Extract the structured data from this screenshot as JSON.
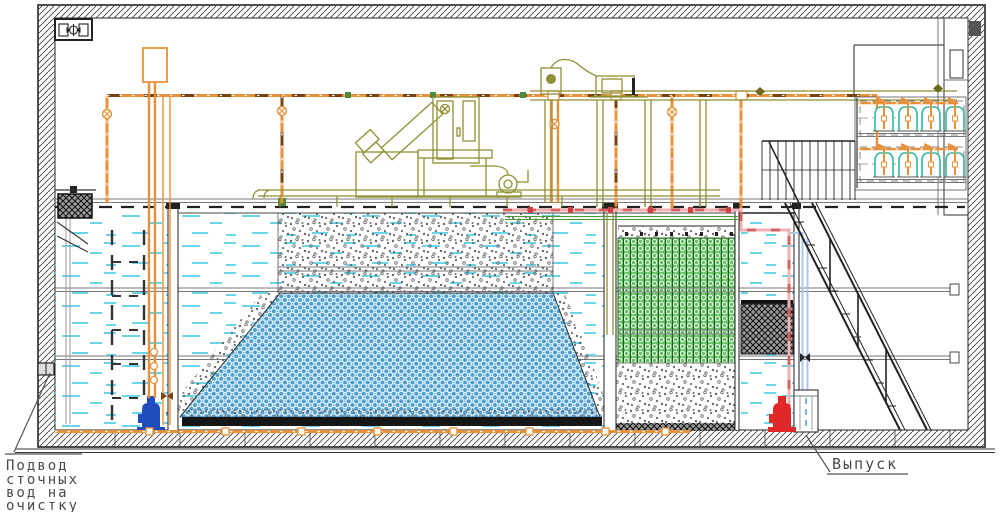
{
  "meta": {
    "title": "Cross-section CAD drawing of a packaged wastewater treatment plant",
    "view": "longitudinal section"
  },
  "labels": {
    "inlet": {
      "lines": [
        "Подвод",
        "сточных",
        "вод на",
        "очистку"
      ]
    },
    "outlet": {
      "text": "Выпуск"
    }
  },
  "colors": {
    "pipe_orange": "#E8913A",
    "pipe_dark_segment": "#7A4210",
    "equipment_olive": "#8F8F33",
    "water_dash_cyan": "#6AD4E8",
    "media_blue": "#4D9FD2",
    "media_green": "#64C064",
    "gravel_gray": "#686868",
    "dark_media": "#9A9A9A",
    "inlet_pump_blue": "#1F4DC0",
    "outlet_pump_red": "#E02828",
    "pipe_pink": "#F2B0B0",
    "pipe_lightblue": "#A9C9E9",
    "diffuser_teal": "#2FB8A3",
    "outline_black": "#222222",
    "label_gray": "#4A4A4A"
  },
  "components": [
    "ventilation-fan",
    "inlet-penetration",
    "basket-screen",
    "receiving-chamber",
    "inlet-pump",
    "feed-tank",
    "screen-press-unit",
    "blower-unit",
    "aeration-tank",
    "gravel-bed",
    "blue-carrier-media",
    "aeration-manifold",
    "biofilter-green-media",
    "dark-filter-media",
    "clear-water-chamber",
    "outlet-pump",
    "outlet-chamber",
    "stairs",
    "service-platform",
    "diffuser-bell-bank",
    "door-shaft"
  ]
}
